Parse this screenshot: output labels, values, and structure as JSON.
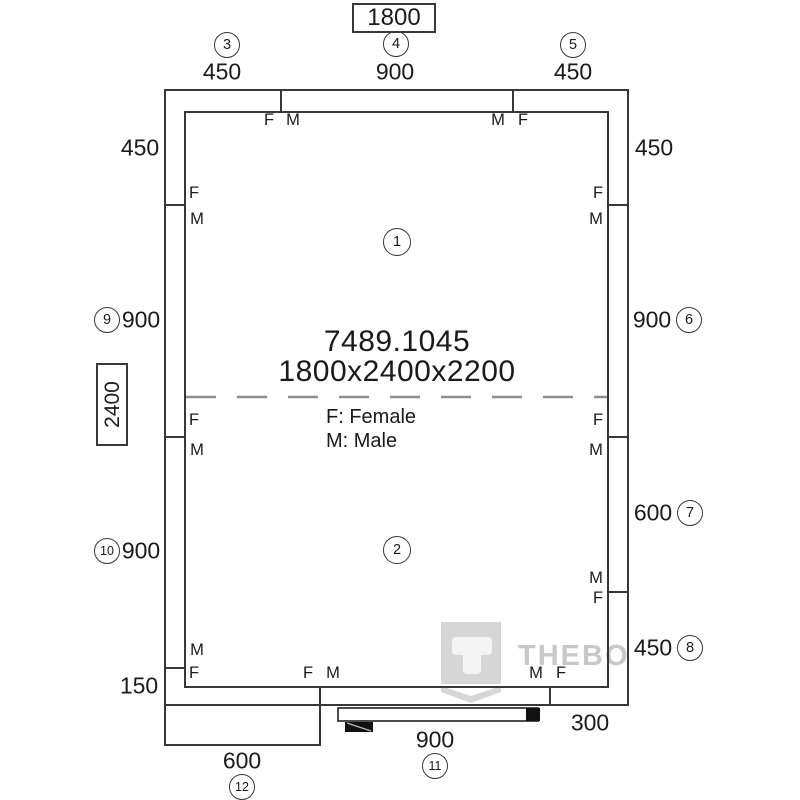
{
  "overall": {
    "width": "1800",
    "depth": "2400"
  },
  "interior": {
    "room1": "1",
    "room2": "2",
    "product_code": "7489.1045",
    "size": "1800x2400x2200",
    "legend_female": "F: Female",
    "legend_male": "M: Male"
  },
  "top_panels": [
    {
      "num": "3",
      "dim": "450"
    },
    {
      "num": "4",
      "dim": "900"
    },
    {
      "num": "5",
      "dim": "450"
    }
  ],
  "left_labels": [
    {
      "dim": "450"
    },
    {
      "num": "9",
      "dim": "900"
    },
    {
      "num": "10",
      "dim": "900"
    },
    {
      "dim": "150"
    }
  ],
  "right_labels": [
    {
      "dim": "450"
    },
    {
      "dim": "900",
      "num": "6"
    },
    {
      "dim": "600",
      "num": "7"
    },
    {
      "dim": "450",
      "num": "8"
    },
    {
      "dim": "300"
    }
  ],
  "bottom_panels": [
    {
      "dim": "600",
      "num": "12"
    },
    {
      "dim": "900",
      "num": "11"
    }
  ],
  "fm": [
    "F",
    "M",
    "M",
    "F",
    "F",
    "M",
    "F",
    "M",
    "M",
    "F",
    "F",
    "M",
    "F",
    "M",
    "M",
    "F",
    "F",
    "M",
    "M",
    "F"
  ],
  "watermark": {
    "brand": "THEBO"
  },
  "colors": {
    "line": "#383838",
    "dashed_centerline": "#8f8f8f",
    "watermark_gray": "#d6d6d6",
    "watermark_text": "#c8c8c8",
    "door_fill": "#111111"
  }
}
